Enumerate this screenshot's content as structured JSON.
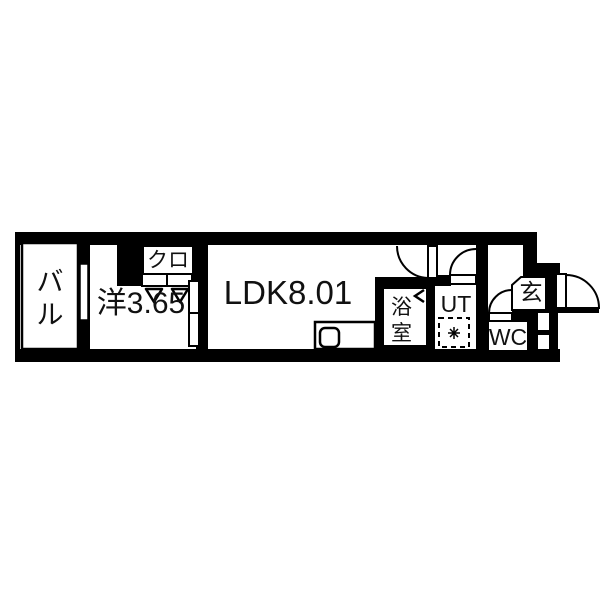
{
  "floorplan": {
    "title": "apartment-floor-plan",
    "colors": {
      "wall": "#000000",
      "background": "#ffffff",
      "line": "#111111"
    },
    "rooms": {
      "balcony": {
        "label": "バル"
      },
      "western_room": {
        "label": "洋3.65"
      },
      "closet": {
        "label": "クロ"
      },
      "ldk": {
        "label": "LDK8.01"
      },
      "bathroom": {
        "label": "浴室"
      },
      "utility": {
        "label": "UT"
      },
      "toilet": {
        "label": "WC"
      },
      "entrance": {
        "label": "玄"
      }
    }
  }
}
